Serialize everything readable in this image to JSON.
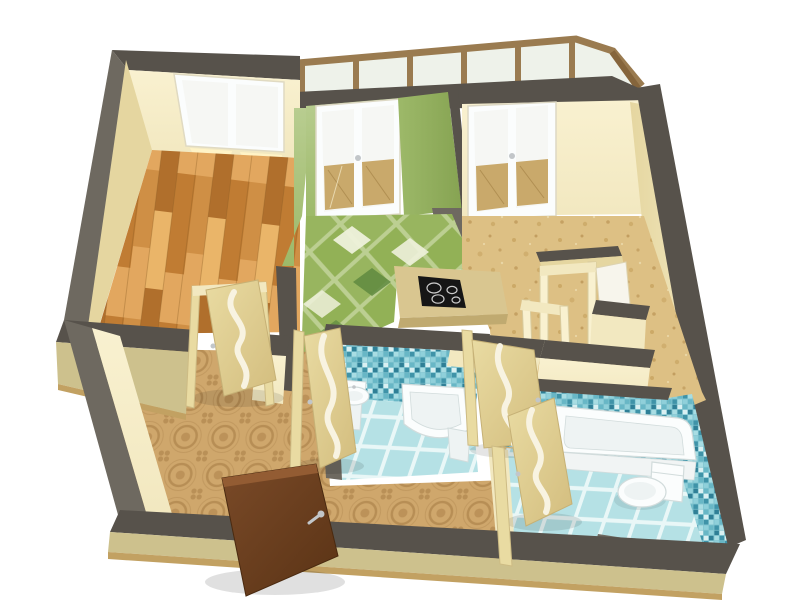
{
  "meta": {
    "title": "3D cutaway floor plan render of a one-bedroom apartment viewed from above",
    "width": 800,
    "height": 608
  },
  "palette": {
    "bg": "#ffffff",
    "wallTop": "#57524b",
    "wallTopLight": "#6e6960",
    "wallTopDark": "#49453f",
    "cream": "#f2e8c0",
    "creamLite": "#f9f1d0",
    "creamShade": "#e5d6a0",
    "khaki": "#cdc18d",
    "khakiDark": "#b9ac77",
    "baseWood": "#c2a162",
    "greenWallLite": "#b8cd90",
    "greenWall": "#9db969",
    "greenWallDark": "#86a352",
    "woodFrame": "#9a7b50",
    "woodFrameDark": "#85653c",
    "glass": "#eef2ea",
    "paneWhite": "#f6f7f4",
    "glow": "#fff3c6",
    "plankA": "#cf8f45",
    "plankB": "#b06f2c",
    "plankC": "#e2a75f",
    "plankD": "#c07c33",
    "plankE": "#eab569",
    "plankLine": "#8a5a22",
    "sand": "#ddc084",
    "sandDotA": "#c5a05c",
    "sandDotB": "#b18747",
    "tileGrout": "#bccf92",
    "tileGreen": "#92b156",
    "tileGreenDark": "#5f8a40",
    "tileWhite": "#eef1db",
    "ornateBase": "#cfa76c",
    "ornateInk": "#a47942",
    "mosaicBase": "#7fc3cf",
    "mosaicA": "#3f93a8",
    "mosaicB": "#68b7c6",
    "mosaicC": "#a8dde3",
    "mosaicD": "#d9f0f2",
    "mosaicE": "#2f7f96",
    "mosaicF": "#8fd0da",
    "bathFloor": "#b5e1e5",
    "bathGrout": "#e9f7f7",
    "fixture": "#fbfdfd",
    "fixtureMid": "#eef3f3",
    "fixtureShade": "#d2dcdc",
    "doorCream": "#e9dba2",
    "doorCreamDark": "#d3bd7e",
    "doorStripe": "#f8f3e1",
    "entryBrown": "#7a4a28",
    "entryBrownDark": "#5a3315",
    "entryBrownTop": "#935c33",
    "handleSilver": "#c2c6c9",
    "cooktop": "#161616",
    "counter": "#d9c690",
    "counterEdge": "#c0aa70",
    "balconyTile": "#c9a96b"
  },
  "rooms": [
    {
      "id": "bedroom",
      "label": "room with parquet floor and large window"
    },
    {
      "id": "kitchen",
      "label": "kitchen with green walls, diamond tile floor, cooktop and glazed balcony doors"
    },
    {
      "id": "living-room",
      "label": "room with cork floor and glazed balcony doors"
    },
    {
      "id": "hallway",
      "label": "entrance hall with ornamental tile floor and open front door"
    },
    {
      "id": "small-bathroom",
      "label": "washroom with blue mosaic walls, washbasin and corner tray"
    },
    {
      "id": "main-bathroom",
      "label": "bathroom with bathtub, toilet and bidet"
    },
    {
      "id": "storage",
      "label": "built-in closets with open white panels"
    },
    {
      "id": "balcony-glazing",
      "label": "wood framed balcony glazing band"
    }
  ],
  "fixtures": [
    "bathtub",
    "toilet",
    "bidet",
    "washbasin",
    "corner-shower-tray",
    "cooktop-4-burners",
    "bedroom-window",
    "balcony-french-doors"
  ],
  "doors": {
    "entry": "open brown entrance door with silver lever handle",
    "interior": "four cream doors with wavy frosted glass stripe"
  }
}
